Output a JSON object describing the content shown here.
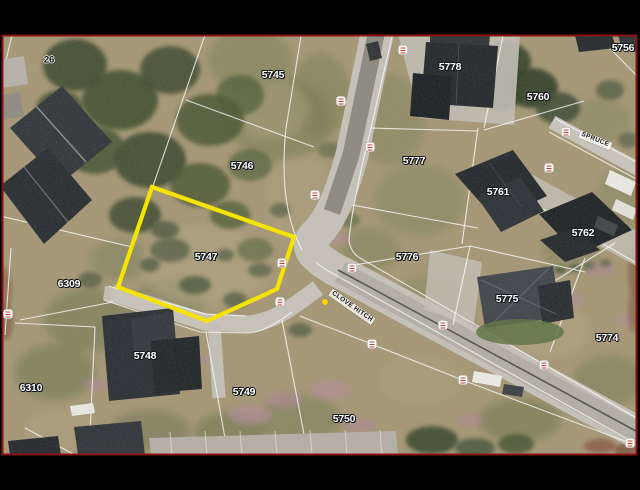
{
  "map": {
    "description": "Aerial cadastral photo with highlighted erf",
    "frame_color": "#8a1410",
    "background_color": "#000000",
    "highlight": {
      "parcel": "5747",
      "outline_color": "#f5e400"
    },
    "parcel_labels": [
      {
        "text": "26",
        "x": 49,
        "y": 60,
        "dark": true
      },
      {
        "text": "5745",
        "x": 273,
        "y": 75,
        "dark": false
      },
      {
        "text": "5746",
        "x": 242,
        "y": 166,
        "dark": false
      },
      {
        "text": "5747",
        "x": 206,
        "y": 257,
        "dark": false
      },
      {
        "text": "6309",
        "x": 69,
        "y": 284,
        "dark": false
      },
      {
        "text": "6310",
        "x": 31,
        "y": 388,
        "dark": false
      },
      {
        "text": "5748",
        "x": 145,
        "y": 356,
        "dark": false
      },
      {
        "text": "5749",
        "x": 244,
        "y": 392,
        "dark": false
      },
      {
        "text": "5750",
        "x": 344,
        "y": 419,
        "dark": false
      },
      {
        "text": "5776",
        "x": 407,
        "y": 257,
        "dark": false
      },
      {
        "text": "5777",
        "x": 414,
        "y": 161,
        "dark": false
      },
      {
        "text": "5778",
        "x": 450,
        "y": 67,
        "dark": false
      },
      {
        "text": "5760",
        "x": 538,
        "y": 97,
        "dark": false
      },
      {
        "text": "5756",
        "x": 623,
        "y": 48,
        "dark": false
      },
      {
        "text": "5761",
        "x": 498,
        "y": 192,
        "dark": false
      },
      {
        "text": "5762",
        "x": 583,
        "y": 233,
        "dark": false
      },
      {
        "text": "5775",
        "x": 507,
        "y": 299,
        "dark": false
      },
      {
        "text": "5774",
        "x": 607,
        "y": 338,
        "dark": false
      }
    ],
    "street_labels": [
      {
        "text": "CLOVE HITCH",
        "x": 352,
        "y": 307,
        "angle": 35
      },
      {
        "text": "SPRUCE",
        "x": 595,
        "y": 140,
        "angle": 22
      }
    ],
    "road_markers": [
      {
        "x": 403,
        "y": 50
      },
      {
        "x": 341,
        "y": 101
      },
      {
        "x": 370,
        "y": 147
      },
      {
        "x": 315,
        "y": 195
      },
      {
        "x": 282,
        "y": 263
      },
      {
        "x": 280,
        "y": 302
      },
      {
        "x": 8,
        "y": 314
      },
      {
        "x": 352,
        "y": 268
      },
      {
        "x": 372,
        "y": 344
      },
      {
        "x": 443,
        "y": 325
      },
      {
        "x": 463,
        "y": 380
      },
      {
        "x": 544,
        "y": 365
      },
      {
        "x": 630,
        "y": 443
      },
      {
        "x": 566,
        "y": 132
      },
      {
        "x": 549,
        "y": 168
      }
    ],
    "poi_dot": {
      "x": 325,
      "y": 302,
      "color": "#ffd400"
    }
  }
}
